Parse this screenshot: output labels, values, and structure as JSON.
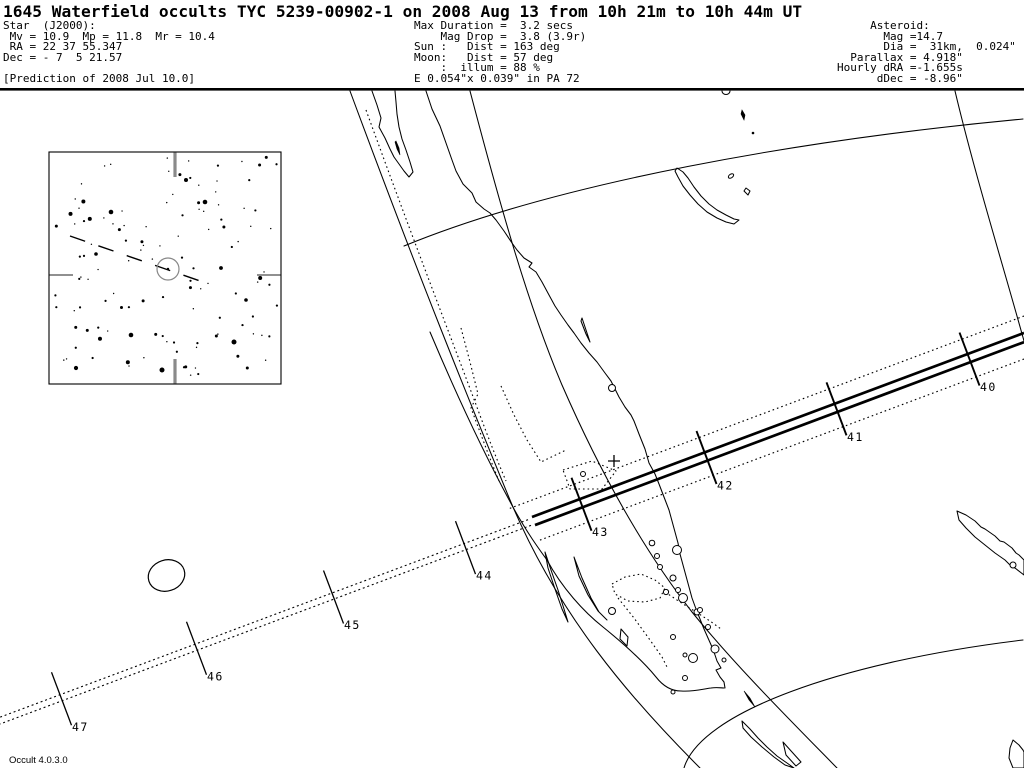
{
  "title": "1645 Waterfield occults TYC 5239-00902-1 on 2008 Aug 13 from 10h 21m to 10h 44m UT",
  "header": {
    "star_lines": [
      "Star  (J2000):",
      " Mv = 10.9  Mp = 11.8  Mr = 10.4",
      " RA = 22 37 55.347",
      "Dec = - 7  5 21.57",
      "",
      "[Prediction of 2008 Jul 10.0]"
    ],
    "event_lines": [
      "Max Duration =  3.2 secs",
      "    Mag Drop =  3.8 (3.9r)",
      "Sun :   Dist = 163 deg",
      "Moon:   Dist = 57 deg",
      "    :  illum = 88 %",
      "E 0.054\"x 0.039\" in PA 72"
    ],
    "asteroid_lines": [
      "     Asteroid:",
      "       Mag =14.7",
      "       Dia =  31km,  0.024\"",
      "  Parallax = 4.918\"",
      "Hourly dRA =-1.655s",
      "      dDec = -8.96\""
    ]
  },
  "map": {
    "version_label": "Occult 4.0.3.0",
    "path_tick_minutes": [
      {
        "label": "40",
        "x": 969
      },
      {
        "label": "41",
        "x": 836
      },
      {
        "label": "42",
        "x": 706
      },
      {
        "label": "43",
        "x": 581
      },
      {
        "label": "44",
        "x": 465
      },
      {
        "label": "45",
        "x": 333
      },
      {
        "label": "46",
        "x": 196
      },
      {
        "label": "47",
        "x": 61
      }
    ],
    "cross_marker": {
      "x": 614,
      "y": 461
    },
    "colors": {
      "ink": "#000000",
      "background": "#ffffff",
      "inset_tick_gray": "#8a8a8a",
      "target_circle_gray": "#888888"
    }
  },
  "inset": {
    "starfield_seed": 20080813,
    "star_count": 120,
    "bright_stars": [
      [
        111,
        212,
        2.3
      ],
      [
        205,
        202,
        2.3
      ],
      [
        234,
        342,
        2.5
      ],
      [
        131,
        335,
        2.3
      ],
      [
        162,
        370,
        2.5
      ],
      [
        76,
        368,
        2.1
      ],
      [
        221,
        268,
        1.9
      ],
      [
        246,
        300,
        1.8
      ],
      [
        96,
        254,
        1.8
      ],
      [
        186,
        180,
        2.0
      ]
    ]
  }
}
